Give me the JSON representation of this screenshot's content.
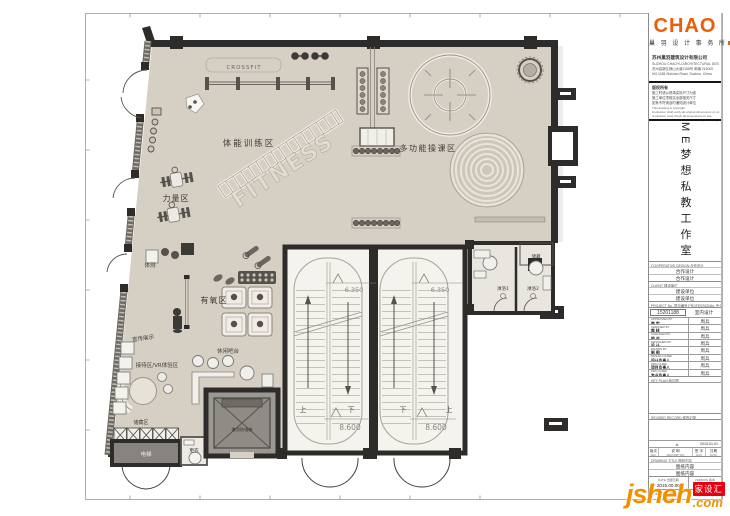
{
  "sheet": {
    "firm": {
      "logo": "CHAO",
      "logo_sub": "巢 羽 设 计 事 务 所",
      "company_cn": "苏州巢羽建筑设计有限公司",
      "company_en": "SUZHOU CHAOYU ARCHITECTURAL DESIGN CO.,LTD",
      "address_cn": "苏州高新区狮山大道1188号 邮编 215000",
      "address_en": "NO.1188 Shishan Road, Suzhou, China"
    },
    "notes": {
      "cn_title": "版权所有",
      "cn_lines": [
        "施工时请以现场实际尺寸为准",
        "施工单位须核实全部相关尺寸",
        "如有不符请及时通知设计单位"
      ],
      "en_lines": [
        "This drawing is copyright.",
        "Contractor shall verify all original dimensions on site.",
        "Contractor must check all dimensions on site.",
        "Contractor must be notified immediately in writing."
      ]
    },
    "project_name": "ME梦想私教工作室",
    "coop": {
      "header": "COOPERATIVE DESIGN 合作设计",
      "rows": [
        "合作设计",
        "合作设计"
      ]
    },
    "client": {
      "header": "CLIENT 建设单位",
      "rows": [
        "建设单位",
        "建设单位"
      ]
    },
    "project_no": {
      "header": "PROJECT No. 项目编号  PROFESSIONAL 专业",
      "number": "15201188",
      "profession": "室内设计"
    },
    "approvals": [
      {
        "en": "APPROVED BY",
        "cn": "审 定",
        "name": "周兵"
      },
      {
        "en": "VERIFIED BY",
        "cn": "审 核",
        "name": "周兵"
      },
      {
        "en": "CHECKED BY",
        "cn": "校 对",
        "name": "周兵"
      },
      {
        "en": "DESIGNED BY",
        "cn": "设 计",
        "name": "周兵"
      },
      {
        "en": "DRAWN BY",
        "cn": "制 图",
        "name": "周兵"
      },
      {
        "en": "DESIGN CHIEF",
        "cn": "设计负责人",
        "name": "周兵"
      },
      {
        "en": "PRO.CHIEF",
        "cn": "项目负责人",
        "name": "周兵"
      },
      {
        "en": "PRO.CHIEF",
        "cn": "专业负责人",
        "name": "周兵"
      }
    ],
    "key_plan_header": "KEY PLAN 索引图",
    "revised": {
      "header": "REVISED RECORD 修改记录",
      "row": {
        "rev": "",
        "desc": "A",
        "sign": "",
        "date": "2015.01.01"
      },
      "cols": [
        {
          "cn": "版次",
          "en": "REV."
        },
        {
          "cn": "说 明",
          "en": "DESCRIPTION"
        },
        {
          "cn": "签 字",
          "en": "SIGN"
        },
        {
          "cn": "日期",
          "en": "DATE"
        }
      ]
    },
    "drawing_title": {
      "header": "DRAWING TITLE 图纸内容",
      "rows": [
        "图纸内容",
        "图纸内容"
      ]
    },
    "issue": {
      "date_label": "DATE 出图日期",
      "date": "2015.00.00",
      "version_label": "VERSION 版本",
      "version": "A"
    },
    "sheet_no_label": "SHEET No. 图号"
  },
  "plan": {
    "labels": {
      "crossfit": "CROSSFIT",
      "training": "体能训练区",
      "strength": "力量区",
      "body_test": "体测",
      "cardio": "有氧区",
      "display": "宣传展示",
      "reception": "接待区/VR体验区",
      "bar": "休闲吧台",
      "storage_zone": "储藏区",
      "changing": "更衣",
      "elevator": "电梯",
      "fire_elevator": "兼消防电梯",
      "multi_class": "多功能操课区",
      "storage_small": "储藏",
      "shower1": "淋浴1",
      "shower2": "淋浴2",
      "fitness_watermark": "FITNESS"
    },
    "stairs": {
      "upper_elev_left": "6.350",
      "upper_elev_right": "6.350",
      "lower_elev_left": "8.600",
      "lower_elev_right": "8.600",
      "dir_1": "上",
      "dir_2": "下",
      "dir_3": "下",
      "dir_4": "上"
    }
  },
  "watermark": {
    "brand": "jsheh",
    "tld": ".com",
    "badge": "家设汇"
  },
  "colors": {
    "accent_orange": "#e8600a",
    "watermark_orange": "#f39000",
    "badge_red": "#e60012",
    "wall": "#2d2c2a",
    "floor": "#d6d0c4"
  }
}
